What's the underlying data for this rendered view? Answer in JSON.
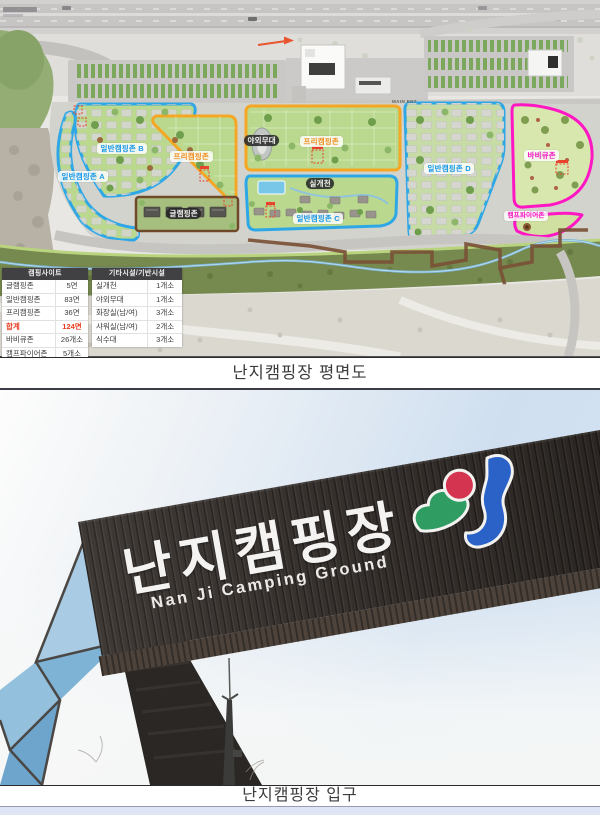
{
  "captions": {
    "figure1": "난지캠핑장 평면도",
    "figure2": "난지캠핑장 입구"
  },
  "map": {
    "main_entrance_label": "MAIN ENT",
    "zone_labels": [
      {
        "id": "zone-b",
        "text": "일반캠핑존 B"
      },
      {
        "id": "zone-a",
        "text": "일반캠핑존 A"
      },
      {
        "id": "free-left",
        "text": "프리캠핑존"
      },
      {
        "id": "stage",
        "text": "야외무대"
      },
      {
        "id": "free-center",
        "text": "프리캠핑존"
      },
      {
        "id": "stream",
        "text": "실개천"
      },
      {
        "id": "zone-c",
        "text": "일반캠핑존 C"
      },
      {
        "id": "glamping",
        "text": "글램핑존"
      },
      {
        "id": "zone-d",
        "text": "일반캠핑존 D"
      },
      {
        "id": "bbq",
        "text": "바비큐존"
      },
      {
        "id": "campfire",
        "text": "캠프파이어존"
      }
    ],
    "site_table": {
      "title": "캠핑사이트",
      "rows": [
        {
          "name": "글램핑존",
          "value": "5면"
        },
        {
          "name": "일반캠핑존",
          "value": "83면"
        },
        {
          "name": "프리캠핑존",
          "value": "36면"
        },
        {
          "name": "합계",
          "value": "124면",
          "highlight": true
        },
        {
          "name": "바비큐존",
          "value": "26개소"
        },
        {
          "name": "캠프파이어존",
          "value": "5개소"
        }
      ]
    },
    "facility_table": {
      "title": "기타시설/기반시설",
      "rows": [
        {
          "name": "실개천",
          "value": "1개소"
        },
        {
          "name": "야외무대",
          "value": "1개소"
        },
        {
          "name": "화장실(남/여)",
          "value": "3개소"
        },
        {
          "name": "샤워실(남/여)",
          "value": "2개소"
        },
        {
          "name": "식수대",
          "value": "3개소"
        }
      ]
    },
    "colors": {
      "zone_general_border": "#2ea7e6",
      "zone_free_border": "#f5a623",
      "zone_bbq_border": "#ff17c3",
      "glamping_border": "#6e4a2a",
      "total_highlight": "#e8391d"
    }
  },
  "photo": {
    "sign_korean": "난지캠핑장",
    "sign_english": "Nan Ji Camping Ground"
  }
}
